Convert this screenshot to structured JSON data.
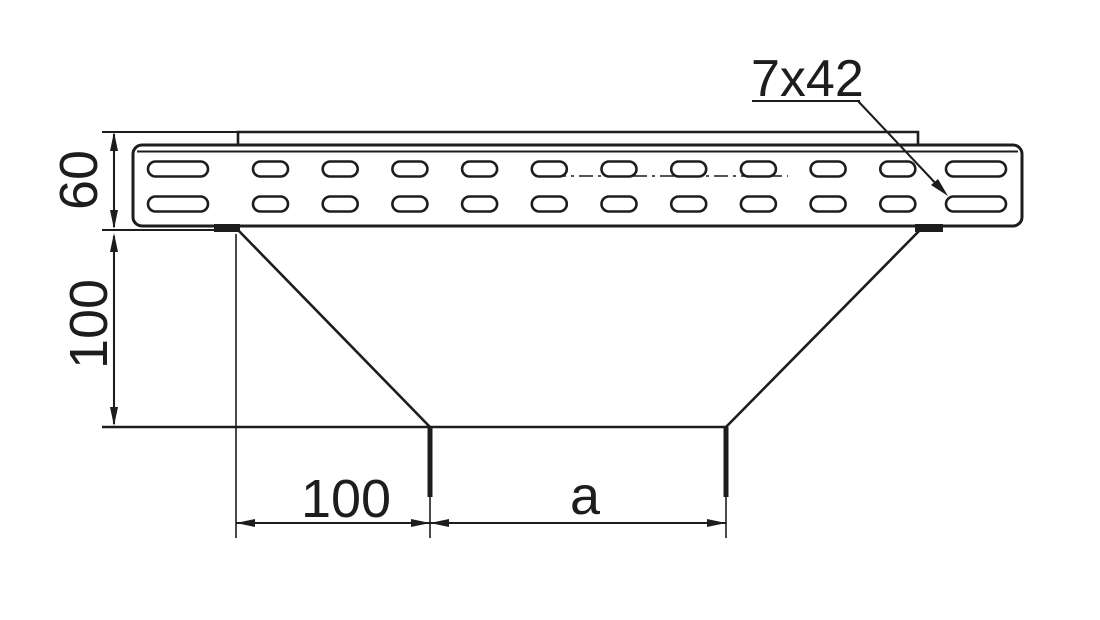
{
  "drawing": {
    "background": "#ffffff",
    "line_color": "#1d1d1b",
    "dimensions": {
      "rail_height": "60",
      "drop_height": "100",
      "offset_width": "100",
      "outlet_width": "a"
    },
    "callout": {
      "slot_size": "7x42"
    },
    "perforation": {
      "small_slot_columns": 10,
      "large_slot_columns": 2,
      "slot_rows": 2
    }
  }
}
